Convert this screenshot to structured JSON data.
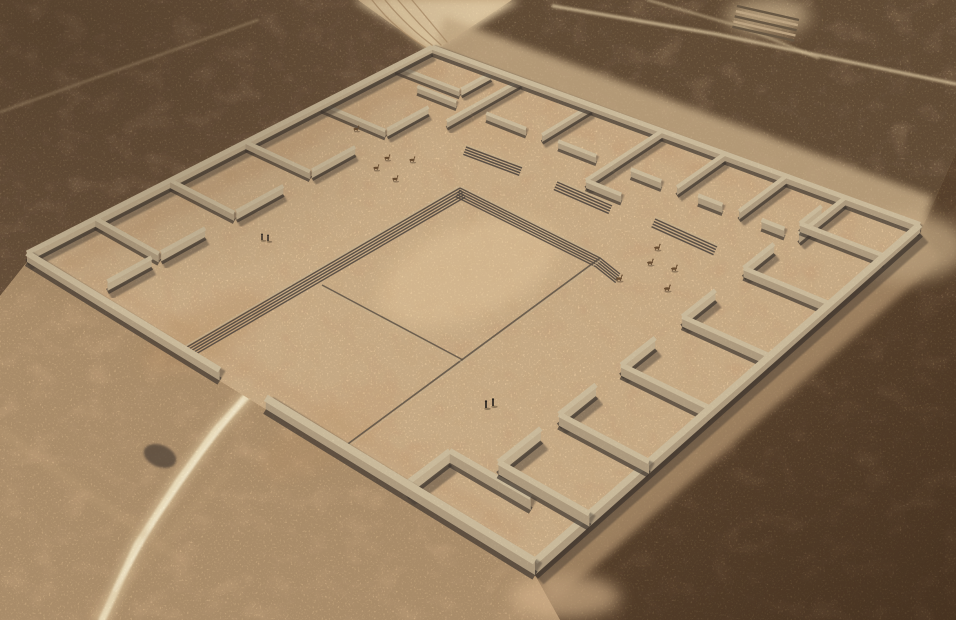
{
  "scene": {
    "description": "Aerial 3D reconstruction of a large square adobe-walled archaeological compound in a desert plain, with perimeter rooms, a central sunken plaza with stepped edges, stair ramps, llamas, small human figures and sandy desert tracks",
    "canvas": {
      "width": 956,
      "height": 620
    },
    "palette": {
      "base_sand": "#c8a981",
      "floor": "#e0bd93",
      "floor_light": "#e9cda1",
      "wall_top": "#d3c3a3",
      "wall_side_lit": "#c7b494",
      "wall_side_dark": "#b5a285",
      "wall_base": "#3e3731",
      "wall_shadow": "#473e34",
      "step_dark": "#4f4740",
      "step_light": "#cdb996",
      "line_dark": "#5d5348",
      "desert_topleft": "#b09174",
      "desert_topright": "#a98d6e",
      "desert_bottomright": "#9c7c5c",
      "desert_bottomleft": "#d8b68c",
      "apron_ne": "#cbb08a",
      "apron_se": "#c7a67e",
      "track_light": "#e4cda6",
      "path_bright": "#f5e8c6",
      "figure_dark": "#2a2521",
      "llama_brown": "#6a4e33"
    },
    "compound": {
      "corners": {
        "w": [
          27,
          262
        ],
        "n": [
          432,
          53
        ],
        "e": [
          920,
          233
        ],
        "s": [
          535,
          575
        ]
      },
      "outer_walls": [
        [
          0,
          0,
          1,
          0
        ],
        [
          1,
          0,
          1,
          1
        ],
        [
          1,
          1,
          0,
          1
        ],
        [
          0,
          1,
          0,
          0.545
        ],
        [
          0,
          0.452,
          0,
          0
        ]
      ],
      "inner_walls": [
        [
          0.14,
          0,
          0.14,
          0.16
        ],
        [
          0.305,
          0,
          0.305,
          0.16
        ],
        [
          0.485,
          0,
          0.485,
          0.16
        ],
        [
          0.68,
          0,
          0.68,
          0.16
        ],
        [
          0.89,
          0,
          0.89,
          0.16
        ],
        [
          0.035,
          0.16,
          0.125,
          0.16
        ],
        [
          0.145,
          0.16,
          0.24,
          0.16
        ],
        [
          0.31,
          0.16,
          0.42,
          0.16
        ],
        [
          0.49,
          0.16,
          0.6,
          0.16
        ],
        [
          0.685,
          0.16,
          0.8,
          0.16
        ],
        [
          0.895,
          0.16,
          0.985,
          0.16
        ],
        [
          1,
          0.22,
          0.85,
          0.22
        ],
        [
          1,
          0.38,
          0.85,
          0.38
        ],
        [
          1,
          0.53,
          0.85,
          0.53
        ],
        [
          1,
          0.655,
          0.85,
          0.655
        ],
        [
          1,
          0.77,
          0.85,
          0.77
        ],
        [
          1,
          0.875,
          0.85,
          0.875
        ],
        [
          0.85,
          0.09,
          0.85,
          0.185
        ],
        [
          0.85,
          0.255,
          0.85,
          0.345
        ],
        [
          0.85,
          0.415,
          0.85,
          0.495
        ],
        [
          0.85,
          0.565,
          0.85,
          0.625
        ],
        [
          0.85,
          0.695,
          0.85,
          0.74
        ],
        [
          0.85,
          0.81,
          0.85,
          0.85
        ],
        [
          0.85,
          0.53,
          0.77,
          0.53
        ],
        [
          0.77,
          0.53,
          0.77,
          0.6
        ],
        [
          0.85,
          0.22,
          0.78,
          0.22
        ],
        [
          0.11,
          1,
          0.11,
          0.86
        ],
        [
          0.24,
          1,
          0.24,
          0.86
        ],
        [
          0.385,
          1,
          0.385,
          0.86
        ],
        [
          0.54,
          1,
          0.54,
          0.86
        ],
        [
          0.71,
          1,
          0.71,
          0.86
        ],
        [
          0.88,
          1,
          0.88,
          0.86
        ],
        [
          0.11,
          0.86,
          0.2,
          0.86
        ],
        [
          0.24,
          0.86,
          0.325,
          0.86
        ],
        [
          0.385,
          0.86,
          0.47,
          0.86
        ],
        [
          0.54,
          0.86,
          0.63,
          0.86
        ],
        [
          0.71,
          0.86,
          0.8,
          0.86
        ],
        [
          0.88,
          0.86,
          0.95,
          0.86
        ],
        [
          0,
          0.8,
          0.085,
          0.8
        ],
        [
          0.085,
          0.8,
          0.085,
          0.93
        ]
      ],
      "floor_shading": [
        {
          "from": [
            0.03,
            0.055
          ],
          "to": [
            0.97,
            0.055
          ],
          "width": 14,
          "opacity": 0.28
        },
        {
          "from": [
            0.045,
            0.1
          ],
          "to": [
            0.045,
            0.95
          ],
          "width": 12,
          "opacity": 0.25
        },
        {
          "from": [
            0.955,
            0.1
          ],
          "to": [
            0.955,
            0.92
          ],
          "width": 11,
          "opacity": 0.18
        }
      ],
      "floor_patches": [
        {
          "cx": 205,
          "cy": 332,
          "rx": 70,
          "ry": 26,
          "rot": -28,
          "fill": "#b98f63",
          "opacity": 0.28
        },
        {
          "cx": 330,
          "cy": 432,
          "rx": 80,
          "ry": 28,
          "rot": -30,
          "fill": "#c49a6d",
          "opacity": 0.2
        },
        {
          "cx": 470,
          "cy": 122,
          "rx": 68,
          "ry": 20,
          "rot": 20,
          "fill": "#c8a072",
          "opacity": 0.18
        },
        {
          "cx": 468,
          "cy": 272,
          "rx": 95,
          "ry": 46,
          "rot": -21,
          "fill": "#e9cda1",
          "opacity": 0.5
        }
      ]
    },
    "plaza": {
      "nw_steps": {
        "from": [
          182,
          350
        ],
        "to": [
          460,
          188
        ],
        "stripes": 5,
        "offset": [
          1.16,
          1.99
        ],
        "spacing": 2.6
      },
      "ne_steps": {
        "from": [
          460,
          188
        ],
        "to": [
          600,
          258
        ],
        "tail": [
          620,
          274
        ],
        "stripes": 5,
        "offset": [
          -1.03,
          2.06
        ],
        "spacing": 2.4
      },
      "se_line": {
        "from": [
          341,
          449
        ],
        "to": [
          600,
          258
        ]
      },
      "sw_line": {
        "from": [
          322,
          285
        ],
        "to": [
          463,
          360
        ]
      },
      "ramps": [
        {
          "from": [
            466,
            147
          ],
          "to": [
            522,
            168
          ],
          "stripes": 4,
          "spacing": 2.6
        },
        {
          "from": [
            557,
            182
          ],
          "to": [
            612,
            206
          ],
          "stripes": 4,
          "spacing": 2.7
        },
        {
          "from": [
            655,
            219
          ],
          "to": [
            717,
            247
          ],
          "stripes": 4,
          "spacing": 2.8
        }
      ]
    },
    "desert": {
      "regions": [
        {
          "name": "top-left",
          "points": [
            [
              0,
              0
            ],
            [
              358,
              0
            ],
            [
              432,
              53
            ],
            [
              27,
              262
            ],
            [
              0,
              296
            ]
          ],
          "fill": "#b09174",
          "blotch": 0.9,
          "speckle": 0.8
        },
        {
          "name": "top-right",
          "points": [
            [
              512,
              0
            ],
            [
              956,
              0
            ],
            [
              956,
              152
            ],
            [
              920,
              233
            ],
            [
              432,
              53
            ]
          ],
          "fill": "#a98d6e",
          "blotch": 1.0,
          "speckle": 0.85
        },
        {
          "name": "bottom-right",
          "points": [
            [
              920,
              233
            ],
            [
              956,
              152
            ],
            [
              956,
              620
            ],
            [
              560,
              620
            ],
            [
              535,
              575
            ]
          ],
          "fill": "#9c7c5c",
          "blotch": 1.0,
          "speckle": 1.0
        },
        {
          "name": "bottom-left",
          "points": [
            [
              0,
              296
            ],
            [
              27,
              262
            ],
            [
              535,
              575
            ],
            [
              560,
              620
            ],
            [
              0,
              620
            ]
          ],
          "fill": "#d8b68c",
          "blotch": 0.25,
          "speckle": 0.3
        }
      ],
      "track_wedge": {
        "points": [
          [
            352,
            0
          ],
          [
            520,
            0
          ],
          [
            455,
            40
          ],
          [
            432,
            53
          ],
          [
            400,
            28
          ]
        ],
        "fill": "#e4cda6"
      },
      "aprons": [
        {
          "points": [
            [
              432,
              53
            ],
            [
              920,
              233
            ],
            [
              933,
              197
            ],
            [
              445,
              17
            ]
          ],
          "fill": "#cbb08a",
          "opacity": 0.85
        },
        {
          "points": [
            [
              535,
              575
            ],
            [
              920,
              233
            ],
            [
              942,
              258
            ],
            [
              557,
              600
            ]
          ],
          "fill": "#c7a67e",
          "opacity": 0.8
        }
      ],
      "light_blobs": [
        {
          "cx": 905,
          "cy": 247,
          "rx": 62,
          "ry": 34,
          "fill": "#cfb38c",
          "opacity": 0.85
        },
        {
          "cx": 565,
          "cy": 597,
          "rx": 55,
          "ry": 22,
          "fill": "#d4b28a",
          "opacity": 0.9
        },
        {
          "cx": 768,
          "cy": 16,
          "rx": 42,
          "ry": 18,
          "fill": "#d6bd96",
          "opacity": 0.7
        }
      ],
      "dark_blob": {
        "cx": 160,
        "cy": 456,
        "rx": 17,
        "ry": 11,
        "rot": 22,
        "fill": "#564a3e",
        "opacity": 0.8
      },
      "step_patch": {
        "from": [
          737,
          6
        ],
        "to": [
          799,
          20
        ],
        "stripes": 5,
        "offset": [
          -1.17,
          5.17
        ]
      }
    },
    "paths": [
      {
        "name": "west-entrance-track-glow",
        "points": [
          [
            247,
            396
          ],
          [
            216,
            430
          ],
          [
            178,
            482
          ],
          [
            137,
            545
          ],
          [
            102,
            620
          ]
        ],
        "color": "#e6cfa5",
        "width": 15,
        "opacity": 0.55,
        "blur": 3
      },
      {
        "name": "west-entrance-track",
        "points": [
          [
            247,
            396
          ],
          [
            216,
            430
          ],
          [
            178,
            482
          ],
          [
            137,
            545
          ],
          [
            102,
            620
          ]
        ],
        "color": "#f5e8c6",
        "width": 7,
        "opacity": 0.95,
        "blur": 1
      },
      {
        "name": "west-entrance-core",
        "points": [
          [
            243,
            400
          ],
          [
            200,
            455
          ],
          [
            155,
            520
          ],
          [
            115,
            590
          ]
        ],
        "color": "#faf0d4",
        "width": 3,
        "opacity": 0.9,
        "blur": 0.5
      },
      {
        "name": "entrance-spur",
        "points": [
          [
            247,
            396
          ],
          [
            270,
            385
          ]
        ],
        "color": "#ead7af",
        "width": 5,
        "opacity": 0.6,
        "blur": 2
      },
      {
        "name": "top-right-path-1",
        "points": [
          [
            553,
            6
          ],
          [
            716,
            34
          ],
          [
            956,
            84
          ]
        ],
        "color": "#e6d2aa",
        "width": 3,
        "opacity": 0.8,
        "blur": 1
      },
      {
        "name": "top-right-path-2",
        "points": [
          [
            648,
            0
          ],
          [
            745,
            28
          ],
          [
            818,
            58
          ]
        ],
        "color": "#dfcaa2",
        "width": 2.4,
        "opacity": 0.6,
        "blur": 1
      },
      {
        "name": "top-left-path",
        "points": [
          [
            0,
            112
          ],
          [
            140,
            62
          ],
          [
            258,
            20
          ]
        ],
        "color": "#d6bd96",
        "width": 2.2,
        "opacity": 0.5,
        "blur": 1
      },
      {
        "name": "sand-streak-1",
        "points": [
          [
            0,
            430
          ],
          [
            180,
            560
          ]
        ],
        "color": "#cfae84",
        "width": 6,
        "opacity": 0.35,
        "blur": 4
      },
      {
        "name": "sand-streak-2",
        "points": [
          [
            230,
            470
          ],
          [
            90,
            620
          ]
        ],
        "color": "#cfae84",
        "width": 5,
        "opacity": 0.3,
        "blur": 4
      },
      {
        "name": "track-rut-core",
        "points": [
          [
            392,
            0
          ],
          [
            415,
            27
          ],
          [
            438,
            46
          ]
        ],
        "color": "#ecd7ae",
        "width": 6,
        "opacity": 0.6,
        "blur": 2
      }
    ],
    "ruts": [
      {
        "d": "M372,0 Q395,30 430,50"
      },
      {
        "d": "M385,0 Q408,28 436,48"
      },
      {
        "d": "M398,0 Q420,26 441,45"
      },
      {
        "d": "M412,0 Q432,24 447,42"
      }
    ],
    "figures": {
      "people": [
        [
          262,
          240
        ],
        [
          268,
          241
        ],
        [
          486,
          408
        ],
        [
          493,
          406
        ]
      ],
      "llamas": [
        [
          657,
          250
        ],
        [
          650,
          265
        ],
        [
          674,
          271
        ],
        [
          619,
          281
        ],
        [
          667,
          291
        ],
        [
          356,
          131
        ],
        [
          387,
          160
        ],
        [
          376,
          170
        ],
        [
          412,
          162
        ],
        [
          395,
          181
        ]
      ]
    }
  }
}
